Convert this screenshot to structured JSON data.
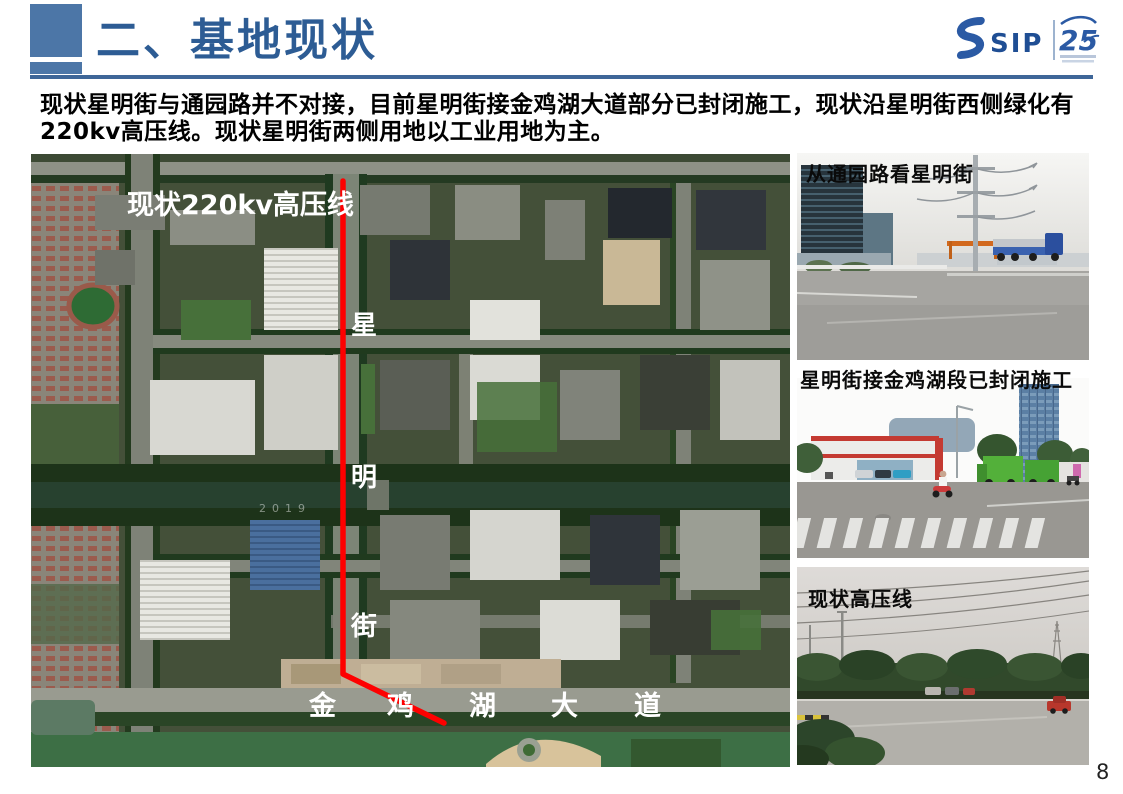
{
  "slide": {
    "title": "二、基地现状",
    "page_number": "8",
    "intro_text": "现状星明街与通园路并不对接，目前星明街接金鸡湖大道部分已封闭施工，现状沿星明街西侧绿化有220kv高压线。现状星明街两侧用地以工业用地为主。"
  },
  "logo": {
    "sip_text": "SIP",
    "anniversary_number": "25"
  },
  "map": {
    "powerline_label": "现状220kv高压线",
    "street_name_chars": [
      "星",
      "明",
      "街"
    ],
    "avenue_name_chars": [
      "金",
      "鸡",
      "湖",
      "大",
      "道"
    ],
    "imagery_watermark": "2019"
  },
  "photos": [
    {
      "caption": "从通园路看星明街"
    },
    {
      "caption": "星明街接金鸡湖段已封闭施工"
    },
    {
      "caption": "现状高压线"
    }
  ],
  "colors": {
    "accent_blue": "#2D5C94",
    "divider_blue": "#3E6698",
    "route_red": "#FE0000"
  }
}
